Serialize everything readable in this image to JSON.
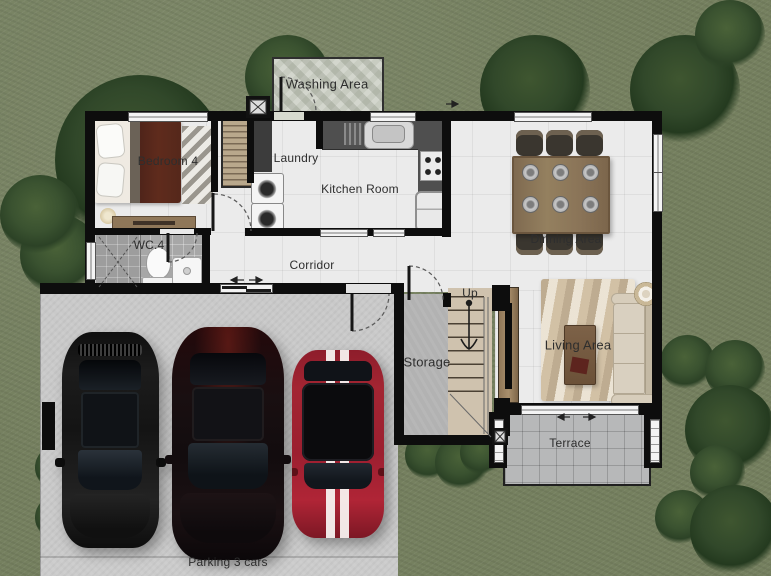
{
  "labels": {
    "washing_area": "Washing Area",
    "laundry": "Laundry",
    "kitchen": "Kitchen Room",
    "bedroom4": "Bedroom 4",
    "wc4": "WC.4",
    "corridor": "Corridor",
    "dining": "Dinning Area",
    "up": "Up",
    "storage": "Storage",
    "living": "Living Area",
    "terrace": "Terrace",
    "parking": "Parking 3 cars"
  },
  "colors": {
    "grass": "#75805f",
    "wall": "#0d0d0d",
    "floor": "#ebebeb",
    "garage": "#c9c9c9",
    "storage_floor": "#b2b2b2",
    "stairs": "#cfc2ae",
    "terrace": "#b7b8b9",
    "washing_floor": "#c8ccc1",
    "wc_floor": "#a7a7a7",
    "counter": "#4f4f4f",
    "wood": "#8f7759",
    "sofa": "#d9d0c0",
    "rug": "#dccfb8",
    "blanket_red": "#5f2b1c",
    "car_red": "#a32532"
  }
}
